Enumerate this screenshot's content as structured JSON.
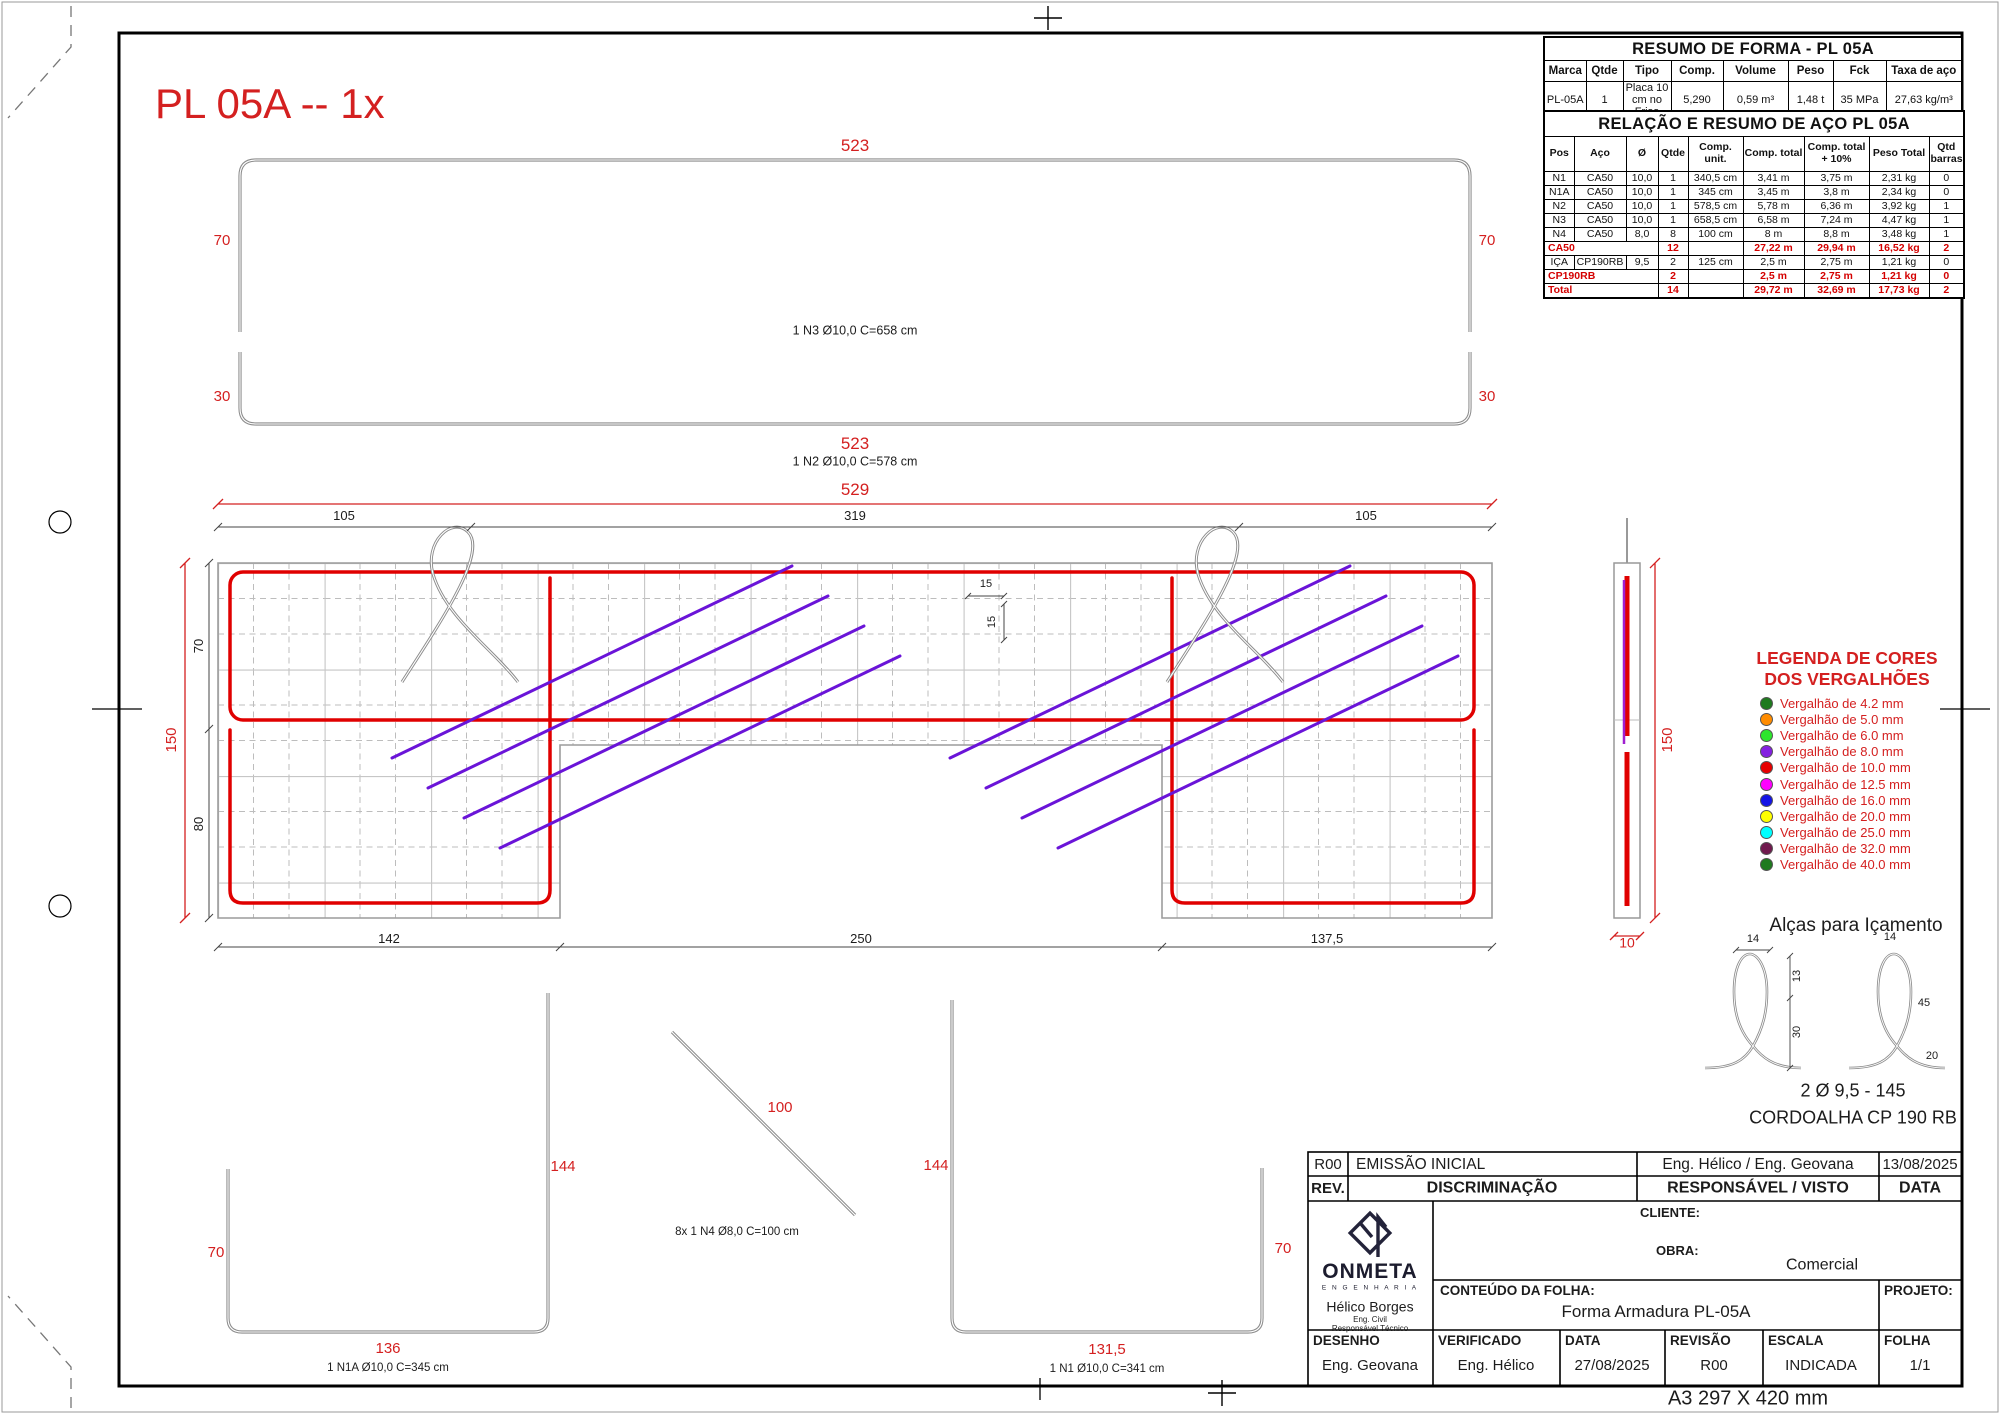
{
  "sheet": {
    "drawing_title": "PL 05A -- 1x",
    "paper_label": "A3 297 X 420 mm"
  },
  "resumo_forma": {
    "title": "RESUMO DE FORMA - PL 05A",
    "headers": [
      "Marca",
      "Qtde",
      "Tipo",
      "Comp.",
      "Volume",
      "Peso",
      "Fck",
      "Taxa de aço"
    ],
    "rows": [
      {
        "red": false,
        "c": [
          {
            "t": "PL-05A"
          },
          {
            "t": "1"
          },
          {
            "t": "Placa 10 cm no Friso"
          },
          {
            "t": "5,290"
          },
          {
            "t": "0,59 m³"
          },
          {
            "t": "1,48 t"
          },
          {
            "t": "35 MPa"
          },
          {
            "t": "27,63 kg/m³"
          }
        ]
      }
    ]
  },
  "relacao_aco": {
    "title": "RELAÇÃO E RESUMO DE AÇO PL 05A",
    "headers": [
      "Pos",
      "Aço",
      "Ø",
      "Qtde",
      "Comp. unit.",
      "Comp. total",
      "Comp. total + 10%",
      "Peso Total",
      "Qtd barras"
    ],
    "rows": [
      {
        "red": false,
        "c": [
          {
            "t": "N1"
          },
          {
            "t": "CA50"
          },
          {
            "t": "10,0"
          },
          {
            "t": "1"
          },
          {
            "t": "340,5 cm"
          },
          {
            "t": "3,41 m"
          },
          {
            "t": "3,75 m"
          },
          {
            "t": "2,31 kg"
          },
          {
            "t": "0"
          }
        ]
      },
      {
        "red": false,
        "c": [
          {
            "t": "N1A"
          },
          {
            "t": "CA50"
          },
          {
            "t": "10,0"
          },
          {
            "t": "1"
          },
          {
            "t": "345 cm"
          },
          {
            "t": "3,45 m"
          },
          {
            "t": "3,8 m"
          },
          {
            "t": "2,34 kg"
          },
          {
            "t": "0"
          }
        ]
      },
      {
        "red": false,
        "c": [
          {
            "t": "N2"
          },
          {
            "t": "CA50"
          },
          {
            "t": "10,0"
          },
          {
            "t": "1"
          },
          {
            "t": "578,5 cm"
          },
          {
            "t": "5,78 m"
          },
          {
            "t": "6,36 m"
          },
          {
            "t": "3,92 kg"
          },
          {
            "t": "1"
          }
        ]
      },
      {
        "red": false,
        "c": [
          {
            "t": "N3"
          },
          {
            "t": "CA50"
          },
          {
            "t": "10,0"
          },
          {
            "t": "1"
          },
          {
            "t": "658,5 cm"
          },
          {
            "t": "6,58 m"
          },
          {
            "t": "7,24 m"
          },
          {
            "t": "4,47 kg"
          },
          {
            "t": "1"
          }
        ]
      },
      {
        "red": false,
        "c": [
          {
            "t": "N4"
          },
          {
            "t": "CA50"
          },
          {
            "t": "8,0"
          },
          {
            "t": "8"
          },
          {
            "t": "100 cm"
          },
          {
            "t": "8 m"
          },
          {
            "t": "8,8 m"
          },
          {
            "t": "3,48 kg"
          },
          {
            "t": "1"
          }
        ]
      },
      {
        "red": true,
        "c": [
          {
            "t": "CA50",
            "cs": 3
          },
          {
            "t": "12"
          },
          {
            "t": ""
          },
          {
            "t": "27,22 m"
          },
          {
            "t": "29,94 m"
          },
          {
            "t": "16,52 kg"
          },
          {
            "t": "2"
          }
        ]
      },
      {
        "red": false,
        "c": [
          {
            "t": "IÇA"
          },
          {
            "t": "CP190RB"
          },
          {
            "t": "9,5"
          },
          {
            "t": "2"
          },
          {
            "t": "125 cm"
          },
          {
            "t": "2,5 m"
          },
          {
            "t": "2,75 m"
          },
          {
            "t": "1,21 kg"
          },
          {
            "t": "0"
          }
        ]
      },
      {
        "red": true,
        "c": [
          {
            "t": "CP190RB",
            "cs": 3
          },
          {
            "t": "2"
          },
          {
            "t": ""
          },
          {
            "t": "2,5 m"
          },
          {
            "t": "2,75 m"
          },
          {
            "t": "1,21 kg"
          },
          {
            "t": "0"
          }
        ]
      },
      {
        "red": true,
        "c": [
          {
            "t": "Total",
            "cs": 3
          },
          {
            "t": "14"
          },
          {
            "t": ""
          },
          {
            "t": "29,72 m"
          },
          {
            "t": "32,69 m"
          },
          {
            "t": "17,73 kg"
          },
          {
            "t": "2"
          }
        ]
      }
    ]
  },
  "legend": {
    "title1": "LEGENDA DE CORES",
    "title2": "DOS VERGALHÕES",
    "items": [
      {
        "color": "#1f7a1f",
        "label": "Vergalhão de 4.2 mm"
      },
      {
        "color": "#ff8c00",
        "label": "Vergalhão de 5.0 mm"
      },
      {
        "color": "#2ee62e",
        "label": "Vergalhão de 6.0 mm"
      },
      {
        "color": "#8420e0",
        "label": "Vergalhão de 8.0 mm"
      },
      {
        "color": "#e60000",
        "label": "Vergalhão de 10.0 mm"
      },
      {
        "color": "#ff00ff",
        "label": "Vergalhão de 12.5 mm"
      },
      {
        "color": "#1414e6",
        "label": "Vergalhão de 16.0 mm"
      },
      {
        "color": "#ffff00",
        "label": "Vergalhão de 20.0 mm"
      },
      {
        "color": "#00ffff",
        "label": "Vergalhão de 25.0 mm"
      },
      {
        "color": "#701a4e",
        "label": "Vergalhão de 32.0 mm"
      },
      {
        "color": "#1f7a1f",
        "label": "Vergalhão de 40.0 mm"
      }
    ]
  },
  "alcas": {
    "title": "Alças para Içamento",
    "spec": "2 Ø 9,5 - 145",
    "type": "CORDOALHA CP 190 RB",
    "dims": {
      "w1": "14",
      "h1": "13",
      "h2": "30",
      "w2": "14",
      "h3": "45",
      "b1": "20"
    }
  },
  "dims": {
    "n3_len_top": "523",
    "n3_leg_l": "70",
    "n3_leg_r": "70",
    "n3_label": "1 N3 Ø10,0 C=658 cm",
    "n2_hook_l": "30",
    "n2_hook_r": "30",
    "n2_len": "523",
    "n2_label": "1 N2 Ø10,0 C=578 cm",
    "plan_total_w": "529",
    "plan_seg1": "105",
    "plan_seg2": "319",
    "plan_seg3": "105",
    "plan_total_h": "150",
    "plan_h1": "70",
    "plan_h2": "80",
    "plan_b1": "142",
    "plan_b2": "250",
    "plan_b3": "137,5",
    "mesh_x": "15",
    "mesh_y": "15",
    "sec_h": "150",
    "sec_w": "10",
    "n1a_leg_r": "144",
    "n1a_leg_l": "70",
    "n1a_base": "136",
    "n1a_label": "1 N1A Ø10,0 C=345 cm",
    "n4_len": "100",
    "n4_label": "8x 1 N4 Ø8,0 C=100 cm",
    "n1_leg_l": "144",
    "n1_leg_r": "70",
    "n1_base": "131,5",
    "n1_label": "1 N1 Ø10,0 C=341 cm"
  },
  "titleblock": {
    "rev_row": {
      "rev": "R00",
      "desc": "EMISSÃO INICIAL",
      "resp": "Eng. Hélico   /  Eng. Geovana",
      "date": "13/08/2025"
    },
    "header_row": {
      "rev": "REV.",
      "desc": "DISCRIMINAÇÃO",
      "resp": "RESPONSÁVEL / VISTO",
      "date": "DATA"
    },
    "logo": {
      "name": "ONMETA",
      "sub": "E N G E N H A R I A",
      "person": "Hélico Borges",
      "role1": "Eng. Civil",
      "role2": "Responsável Técnico"
    },
    "cliente_label": "CLIENTE:",
    "obra_label": "OBRA:",
    "obra_value": "Comercial",
    "conteudo_label": "CONTEÚDO DA FOLHA:",
    "conteudo_value": "Forma Armadura PL-05A",
    "projeto_label": "PROJETO:",
    "fields": [
      {
        "label": "DESENHO",
        "value": "Eng. Geovana"
      },
      {
        "label": "VERIFICADO",
        "value": "Eng. Hélico"
      },
      {
        "label": "DATA",
        "value": "27/08/2025"
      },
      {
        "label": "REVISÃO",
        "value": "R00"
      },
      {
        "label": "ESCALA",
        "value": "INDICADA"
      },
      {
        "label": "FOLHA",
        "value": "1/1"
      }
    ]
  }
}
